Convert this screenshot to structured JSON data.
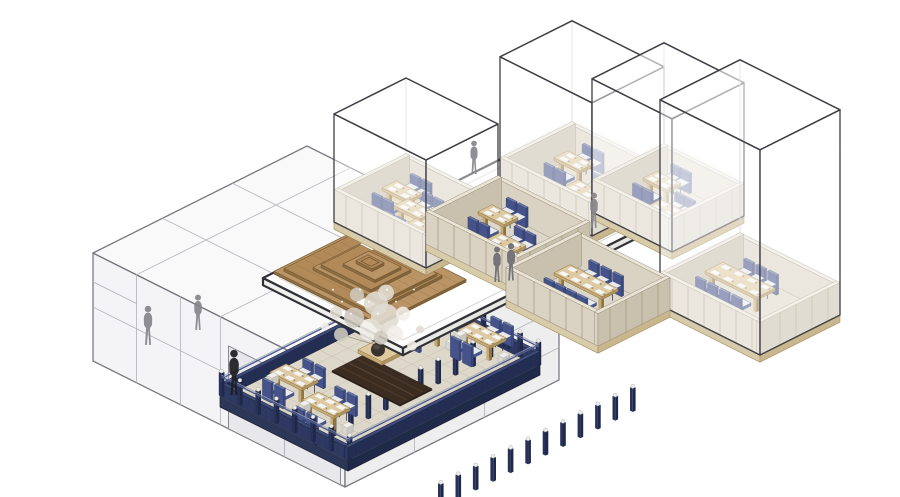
{
  "meta": {
    "diagram_type": "axonometric-architecture-exploded-view",
    "canvas": {
      "width": 900,
      "height": 497
    }
  },
  "palette": {
    "background": "#ffffff",
    "cube_line": "#3d3d45",
    "cube_back": "#c2c2ca",
    "cube_face": "rgba(255,255,255,0.45)",
    "cube_top": "rgba(255,255,255,0.6)",
    "block_line": "#74747d",
    "block_inner": "#b1b1b9",
    "block_top": "#f9f9fa",
    "block_left": "#f4f4f6",
    "block_right": "#eeeeef",
    "block_open": "#e8e8ec",
    "plate_top": "#ffffff",
    "plate_l": "#efefec",
    "plate_r": "#e6e6e2",
    "plate_line": "#303036",
    "plate_inner": "#b9b9c0",
    "slab_l": "#d8cba9",
    "slab_r": "#c8b68e",
    "slab_s": "#a5905f",
    "wall_t": "#eae4d7",
    "wall_l": "#dad3c3",
    "wall_r": "#c9c0ad",
    "wall_s": "#9b907a",
    "wall_post": "#a69a81",
    "floor_wood": "#e2cfa5",
    "wood_plank": "#c6ae7d",
    "floor_carpet": "#ddd7c9",
    "floor_line": "#b9b09c",
    "table_t": "#dfc99e",
    "table_l": "#c5a977",
    "table_r": "#b0945e",
    "table_s": "#8f7443",
    "mat": "#f6f5f1",
    "mat_s": "#cbc5b6",
    "seat_t": "#e8eaee",
    "seat_l": "#55639b",
    "seat_r": "#46558c",
    "seat_s": "#3a4878",
    "back_t": "#6a78a6",
    "back_l": "#45538a",
    "back_r": "#39477c",
    "back_s": "#333f6e",
    "chair_leg": "#2f3a66",
    "ter_floor": "#ded8ca",
    "ter_line": "#c7beac",
    "ter_slab_l": "#2c3758",
    "ter_slab_r": "#1f2a48",
    "ter_slab_s": "#18213c",
    "fence_t": "#3e4b74",
    "fence_l": "#2e3a62",
    "fence_r": "#232e52",
    "fence_s": "#1b2443",
    "fence_slat": "#1f2950",
    "post_cap": "#f1f1ee",
    "rail": "#505e8a",
    "rail_hi": "#97a1bd",
    "rug": "#3b2c21",
    "rug_hi": "#72563a",
    "rug_line": "#2a1f17",
    "roof_top_a": "#bb9465",
    "roof_top_b": "#b28a59",
    "roof_side": "#8f6f42",
    "roof_line": "#7a5c36",
    "roof_plank": "#8a6a42",
    "bench_t": "#f0efeb",
    "bench_l": "#d8d6cf",
    "bench_r": "#c9c7c0",
    "pot": "#38332f",
    "pot_hi": "#514a43",
    "branch": "#8c857a",
    "blossom_a": "#f1eee8",
    "blossom_b": "#e0dcd2",
    "blossom_c": "#cfc9be",
    "fig_gray": "#85858b",
    "fig_gray_dark": "#6d6d73",
    "fig_black": "#1e1e21"
  },
  "scene": {
    "left_block": {
      "x": -33.75,
      "y": 37.75,
      "w": 126,
      "d": 107,
      "h": 60,
      "top_lines": [
        [
          -33.75,
          75,
          92.25,
          75
        ],
        [
          -33.75,
          110,
          92.25,
          110
        ],
        [
          -12,
          37.75,
          -12,
          144.75
        ],
        [
          30,
          37.75,
          30,
          144.75
        ]
      ],
      "front_left_vlines": [
        -12,
        10,
        30
      ],
      "front_left_hlines": [
        [
          30,
          -33.75,
          30
        ],
        [
          44,
          -33.75,
          -12
        ]
      ],
      "opening": {
        "x1": 34,
        "x2": 90,
        "z1": 0,
        "z2": 46,
        "vline": 62,
        "hline": 18
      },
      "front_right_hlines": [
        18,
        40
      ],
      "front_right_vlines": [
        75,
        110
      ]
    },
    "plate": {
      "x": 21.25,
      "y": -15.25,
      "w": 70,
      "d": 130,
      "z": 56,
      "th": 4
    },
    "roof": {
      "cx": 48,
      "cy": 88,
      "z": 60,
      "step": 1.5,
      "layers": [
        [
          52,
          44
        ],
        [
          43,
          36
        ],
        [
          34,
          28
        ],
        [
          25,
          20
        ],
        [
          16,
          13
        ],
        [
          8,
          6
        ]
      ],
      "offsets": [
        [
          0,
          0
        ],
        [
          -2,
          1.5
        ],
        [
          1.5,
          -1
        ],
        [
          -1,
          1
        ],
        [
          1,
          0
        ],
        [
          0,
          0
        ]
      ],
      "gaps": [
        [
          30,
          70,
          6,
          5
        ],
        [
          58,
          101,
          6,
          4
        ]
      ]
    },
    "modules": [
      {
        "name": "room-upper-mid-left",
        "x": 36.5,
        "y": -24.5,
        "w": 46,
        "d": 36,
        "floor": "carpet",
        "cube": {
          "h": 74
        },
        "tables": [
          {
            "cx": 49,
            "cy": -13
          },
          {
            "cx": 66,
            "cy": -1
          }
        ]
      },
      {
        "name": "room-upper-mid-right",
        "x": 70.5,
        "y": -36.5,
        "w": 40,
        "d": 36,
        "floor": "carpet",
        "cube": {
          "h": 74
        },
        "tables": [
          {
            "cx": 81,
            "cy": -25,
            "w": 12
          },
          {
            "cx": 96,
            "cy": -12,
            "w": 12
          }
        ]
      },
      {
        "name": "room-northwest",
        "x": 11,
        "y": 33,
        "w": 46,
        "d": 36,
        "floor": "wood",
        "cube": {
          "h": 60
        },
        "tables": [
          {
            "cx": 21,
            "cy": 45
          },
          {
            "cx": 33,
            "cy": 51
          },
          {
            "cx": 45,
            "cy": 59
          }
        ]
      },
      {
        "name": "room-west-annex",
        "x": 45,
        "y": 21,
        "w": 46,
        "d": 36,
        "floor": "carpet",
        "cube": null,
        "tables": [
          {
            "cx": 57,
            "cy": 33
          },
          {
            "cx": 73,
            "cy": 45
          }
        ]
      },
      {
        "name": "room-east-large",
        "x": 134,
        "y": -11,
        "w": 50,
        "d": 40,
        "floor": "carpet",
        "cube": {
          "h": 114
        },
        "tables": [
          {
            "cx": 150,
            "cy": 5,
            "w": 26,
            "d": 9,
            "nN": 3,
            "nS": 4,
            "mats": 4
          }
        ]
      },
      {
        "name": "room-southeast",
        "x": 93,
        "y": 29,
        "w": 46,
        "d": 36,
        "floor": "carpet",
        "cube": null,
        "tables": [
          {
            "cx": 112,
            "cy": 44,
            "w": 24,
            "d": 8,
            "nN": 3,
            "nS": 4,
            "mats": 4
          }
        ]
      }
    ],
    "terrace": {
      "x": 21,
      "y": 40,
      "w": 64,
      "d": 96,
      "tables": [
        {
          "cx": 38,
          "cy": 116,
          "w": 16,
          "d": 8
        },
        {
          "cx": 60,
          "cy": 122,
          "w": 16,
          "d": 8
        },
        {
          "cx": 44,
          "cy": 54,
          "w": 16,
          "d": 8
        },
        {
          "cx": 64,
          "cy": 48,
          "w": 16,
          "d": 8
        }
      ],
      "rug": {
        "cx": 54,
        "cy": 88,
        "w": 34,
        "d": 16
      },
      "tree": {
        "x": 40,
        "y": 76
      }
    },
    "figures": [
      {
        "x": -28,
        "y": 123,
        "z": 0,
        "h": 40,
        "color": "gray",
        "name": "figure-in-block-1"
      },
      {
        "x": -23,
        "y": 103,
        "z": 0,
        "h": 36,
        "color": "gray",
        "name": "figure-in-block-2"
      },
      {
        "x": 22,
        "y": 10,
        "z": 60,
        "h": 34,
        "color": "gray",
        "name": "figure-upper-level-1"
      },
      {
        "x": 79,
        "y": 7,
        "z": 60,
        "h": 36,
        "color": "gray",
        "name": "figure-upper-level-2"
      },
      {
        "x": 81.75,
        "y": 58.25,
        "z": 60,
        "h": 36,
        "color": "gray_dark",
        "name": "figure-on-plate-1"
      },
      {
        "x": 84.5,
        "y": 54,
        "z": 60,
        "h": 38,
        "color": "gray_dark",
        "name": "figure-on-plate-2"
      },
      {
        "x": 18.5,
        "y": 126.5,
        "z": 0,
        "h": 46,
        "color": "black",
        "name": "figure-ground"
      }
    ]
  }
}
